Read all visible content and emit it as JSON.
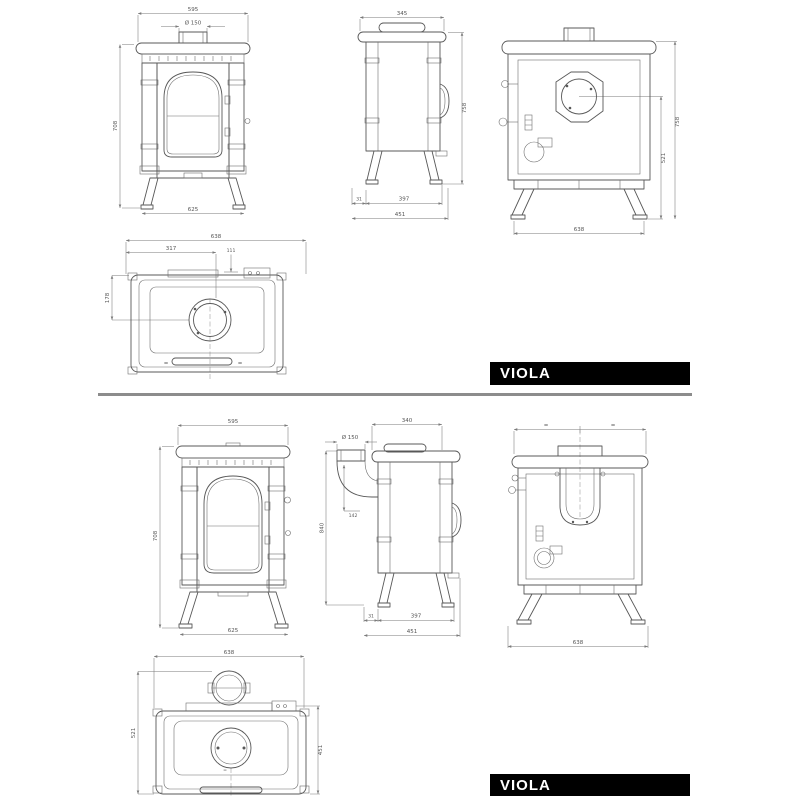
{
  "brand": {
    "label": "VIOLA"
  },
  "colors": {
    "drawing_line": "#585858",
    "dimension_line": "#7a7a7a",
    "label_bar_background": "#000000",
    "label_bar_text": "#ffffff",
    "divider": "#8c8c8c"
  },
  "p1": {
    "front": {
      "width_top": "595",
      "flue_diameter": "Ø 150",
      "height": "708",
      "width_bottom": "625"
    },
    "side": {
      "depth_top": "345",
      "height": "758",
      "leg_offset": "31",
      "leg_span": "397",
      "depth_overall": "451"
    },
    "back": {
      "flue_center_height": "521",
      "height": "758",
      "width_bottom": "638"
    },
    "top": {
      "width_overall": "638",
      "flue_center_from_left": "317",
      "rear_offset": "111",
      "flue_center_from_back": "178",
      "equal_left": "=",
      "equal_right": "="
    }
  },
  "p2": {
    "front": {
      "width_top": "595",
      "height": "708",
      "width_bottom": "625"
    },
    "side": {
      "flue_diameter": "Ø 150",
      "depth_top": "340",
      "flue_height": "840",
      "flue_drop": "142",
      "leg_offset": "31",
      "leg_span": "397",
      "depth_overall": "451"
    },
    "back": {
      "equal_left": "=",
      "equal_right": "=",
      "width_bottom": "638"
    },
    "top": {
      "width_overall": "638",
      "depth_with_flue": "521",
      "depth_body": "451",
      "equal_center": "="
    }
  }
}
